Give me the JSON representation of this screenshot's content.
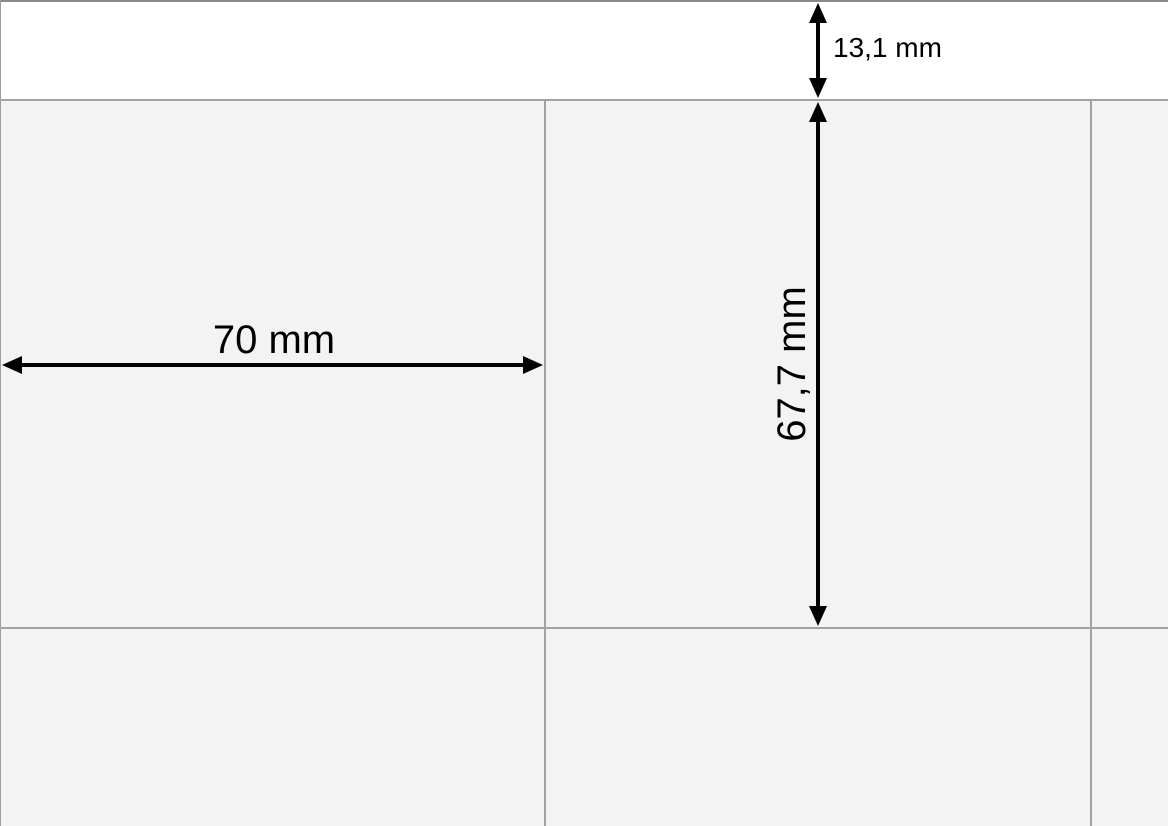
{
  "diagram": {
    "description": "Label sheet page preview with dimension arrows",
    "dimensions": {
      "top_margin": {
        "label": "13,1 mm",
        "value_mm": 13.1,
        "orientation": "vertical"
      },
      "label_width": {
        "label": "70 mm",
        "value_mm": 70,
        "orientation": "horizontal"
      },
      "label_height": {
        "label": "67,7 mm",
        "value_mm": 67.7,
        "orientation": "vertical"
      }
    },
    "grid": {
      "visible_columns": 3,
      "visible_rows": 2
    },
    "colors": {
      "page_background": "#ffffff",
      "label_fill": "#f3f3f3",
      "grid_line": "#a2a2a2",
      "page_border": "#8a8a8a",
      "arrow": "#000000",
      "text": "#000000"
    }
  }
}
